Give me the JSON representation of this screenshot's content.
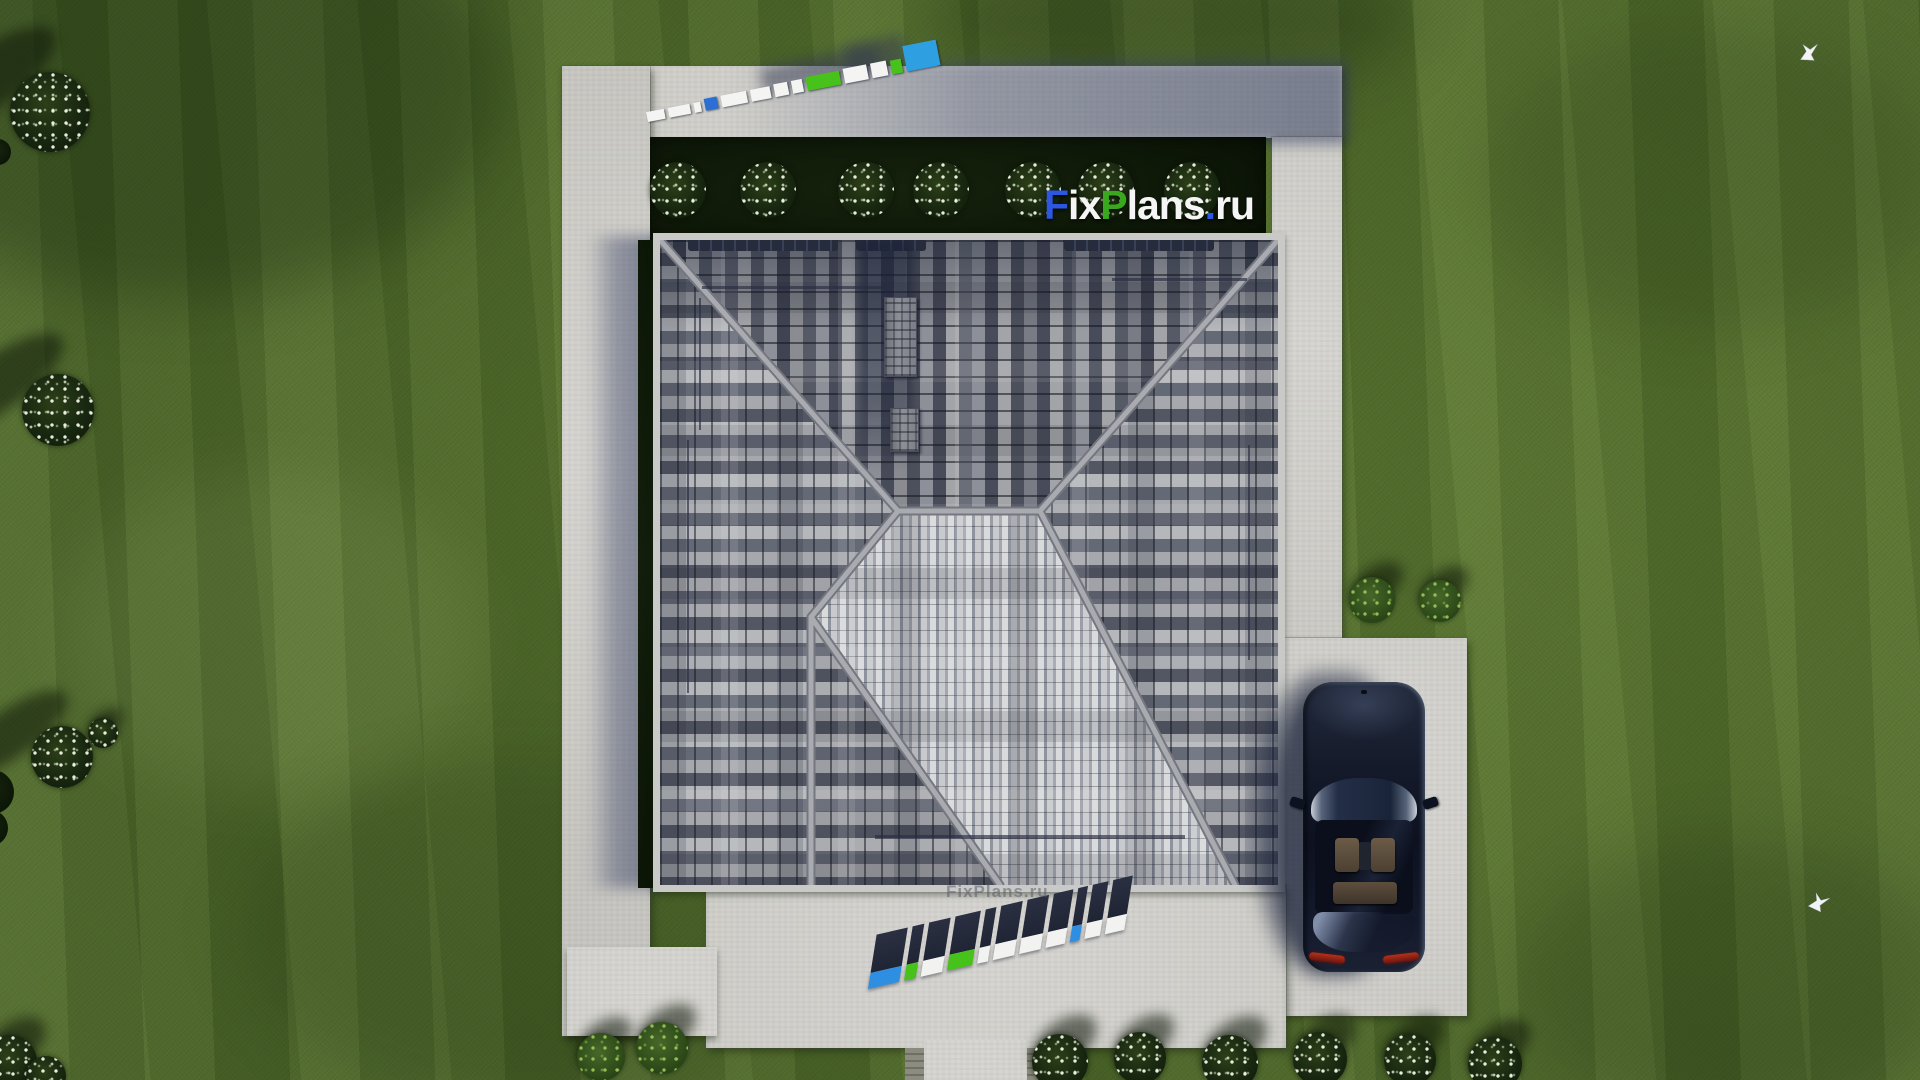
{
  "brand": {
    "logo_text": "FixPlans.ru",
    "logo_parts": [
      {
        "text": "F",
        "color": "#2b57e2"
      },
      {
        "text": "ix",
        "color": "#f5f5f5"
      },
      {
        "text": "P",
        "color": "#39a81d"
      },
      {
        "text": "lans",
        "color": "#f5f5f5"
      },
      {
        "text": ".",
        "color": "#2b57e2"
      },
      {
        "text": "ru",
        "color": "#f5f5f5"
      }
    ]
  },
  "watermarks": {
    "ground_text_front": "FixPlans.ru",
    "faint_eave_text": "FixPlans.ru",
    "top_blocks": [
      {
        "w": 18,
        "h": 10,
        "c": "#f4f4f2"
      },
      {
        "w": 22,
        "h": 10,
        "c": "#f4f4f2"
      },
      {
        "w": 7,
        "h": 10,
        "c": "#f4f4f2"
      },
      {
        "w": 13,
        "h": 12,
        "c": "#2b6fd4"
      },
      {
        "w": 26,
        "h": 12,
        "c": "#f4f4f2"
      },
      {
        "w": 20,
        "h": 12,
        "c": "#f4f4f2"
      },
      {
        "w": 14,
        "h": 13,
        "c": "#f4f4f2"
      },
      {
        "w": 11,
        "h": 13,
        "c": "#f4f4f2"
      },
      {
        "w": 34,
        "h": 14,
        "c": "#47c21a"
      },
      {
        "w": 24,
        "h": 15,
        "c": "#f4f4f2"
      },
      {
        "w": 16,
        "h": 15,
        "c": "#f4f4f2"
      },
      {
        "w": 11,
        "h": 14,
        "c": "#47c21a"
      },
      {
        "w": 34,
        "h": 26,
        "c": "#2e9fe0"
      }
    ],
    "bottom_letters": [
      {
        "w": 32,
        "face": "#2e8ee2"
      },
      {
        "w": 12,
        "face": "#47c21a"
      },
      {
        "w": 22,
        "face": "#f2f2f0"
      },
      {
        "w": 26,
        "face": "#47c21a"
      },
      {
        "w": 11,
        "face": "#f2f2f0"
      },
      {
        "w": 22,
        "face": "#f2f2f0"
      },
      {
        "w": 22,
        "face": "#f2f2f0"
      },
      {
        "w": 20,
        "face": "#f2f2f0"
      },
      {
        "w": 10,
        "face": "#2e8ee2"
      },
      {
        "w": 16,
        "face": "#f2f2f0"
      },
      {
        "w": 20,
        "face": "#f2f2f0"
      }
    ]
  },
  "palette": {
    "grass": "#55712e",
    "concrete": "#d3d2cd",
    "shadow_tint": "#3c4468",
    "bed_dark_green": "#101b0b",
    "roof_tile_light": "#aeb0b5",
    "roof_tile_dark": "#4d5160",
    "roof_bright_slope": "#d9dadc",
    "ridge_gray": "#a6a8ad",
    "car_body_navy": "#151b2b",
    "taillight_red": "#b5321c",
    "logo_blue": "#2b57e2",
    "logo_green": "#39a81d"
  },
  "scene": {
    "hedge_bushes_x": [
      678,
      768,
      866,
      941,
      1033,
      1106,
      1192
    ],
    "hedge_bushes_y": 190,
    "hedge_bush_r": 28,
    "bushes": [
      {
        "x": 50,
        "y": 112,
        "r": 40,
        "type": "flower",
        "sh": "long"
      },
      {
        "x": -2,
        "y": 152,
        "r": 13,
        "type": "dark",
        "sh": "none"
      },
      {
        "x": 58,
        "y": 410,
        "r": 36,
        "type": "flower",
        "sh": "long"
      },
      {
        "x": 62,
        "y": 757,
        "r": 31,
        "type": "flower",
        "sh": "long"
      },
      {
        "x": 103,
        "y": 733,
        "r": 15,
        "type": "flower",
        "sh": "short"
      },
      {
        "x": -8,
        "y": 792,
        "r": 22,
        "type": "dark",
        "sh": "none"
      },
      {
        "x": -10,
        "y": 828,
        "r": 18,
        "type": "dark",
        "sh": "none"
      },
      {
        "x": 10,
        "y": 1062,
        "r": 27,
        "type": "flower",
        "sh": "short"
      },
      {
        "x": 46,
        "y": 1076,
        "r": 20,
        "type": "flower",
        "sh": "none"
      },
      {
        "x": 601,
        "y": 1057,
        "r": 24,
        "type": "green",
        "sh": "short"
      },
      {
        "x": 662,
        "y": 1048,
        "r": 26,
        "type": "green",
        "sh": "short"
      },
      {
        "x": 1372,
        "y": 600,
        "r": 23,
        "type": "green",
        "sh": "short"
      },
      {
        "x": 1440,
        "y": 601,
        "r": 21,
        "type": "green",
        "sh": "short"
      },
      {
        "x": 1060,
        "y": 1062,
        "r": 28,
        "type": "flower",
        "sh": "short"
      },
      {
        "x": 1140,
        "y": 1058,
        "r": 26,
        "type": "flower",
        "sh": "short"
      },
      {
        "x": 1230,
        "y": 1063,
        "r": 28,
        "type": "flower",
        "sh": "short"
      },
      {
        "x": 1320,
        "y": 1059,
        "r": 27,
        "type": "flower",
        "sh": "short"
      },
      {
        "x": 1410,
        "y": 1060,
        "r": 26,
        "type": "flower",
        "sh": "short"
      },
      {
        "x": 1495,
        "y": 1064,
        "r": 27,
        "type": "flower",
        "sh": "short"
      }
    ],
    "birds": [
      {
        "x": 1797,
        "y": 42,
        "rot": -10
      },
      {
        "x": 1806,
        "y": 892,
        "rot": 12
      }
    ]
  }
}
